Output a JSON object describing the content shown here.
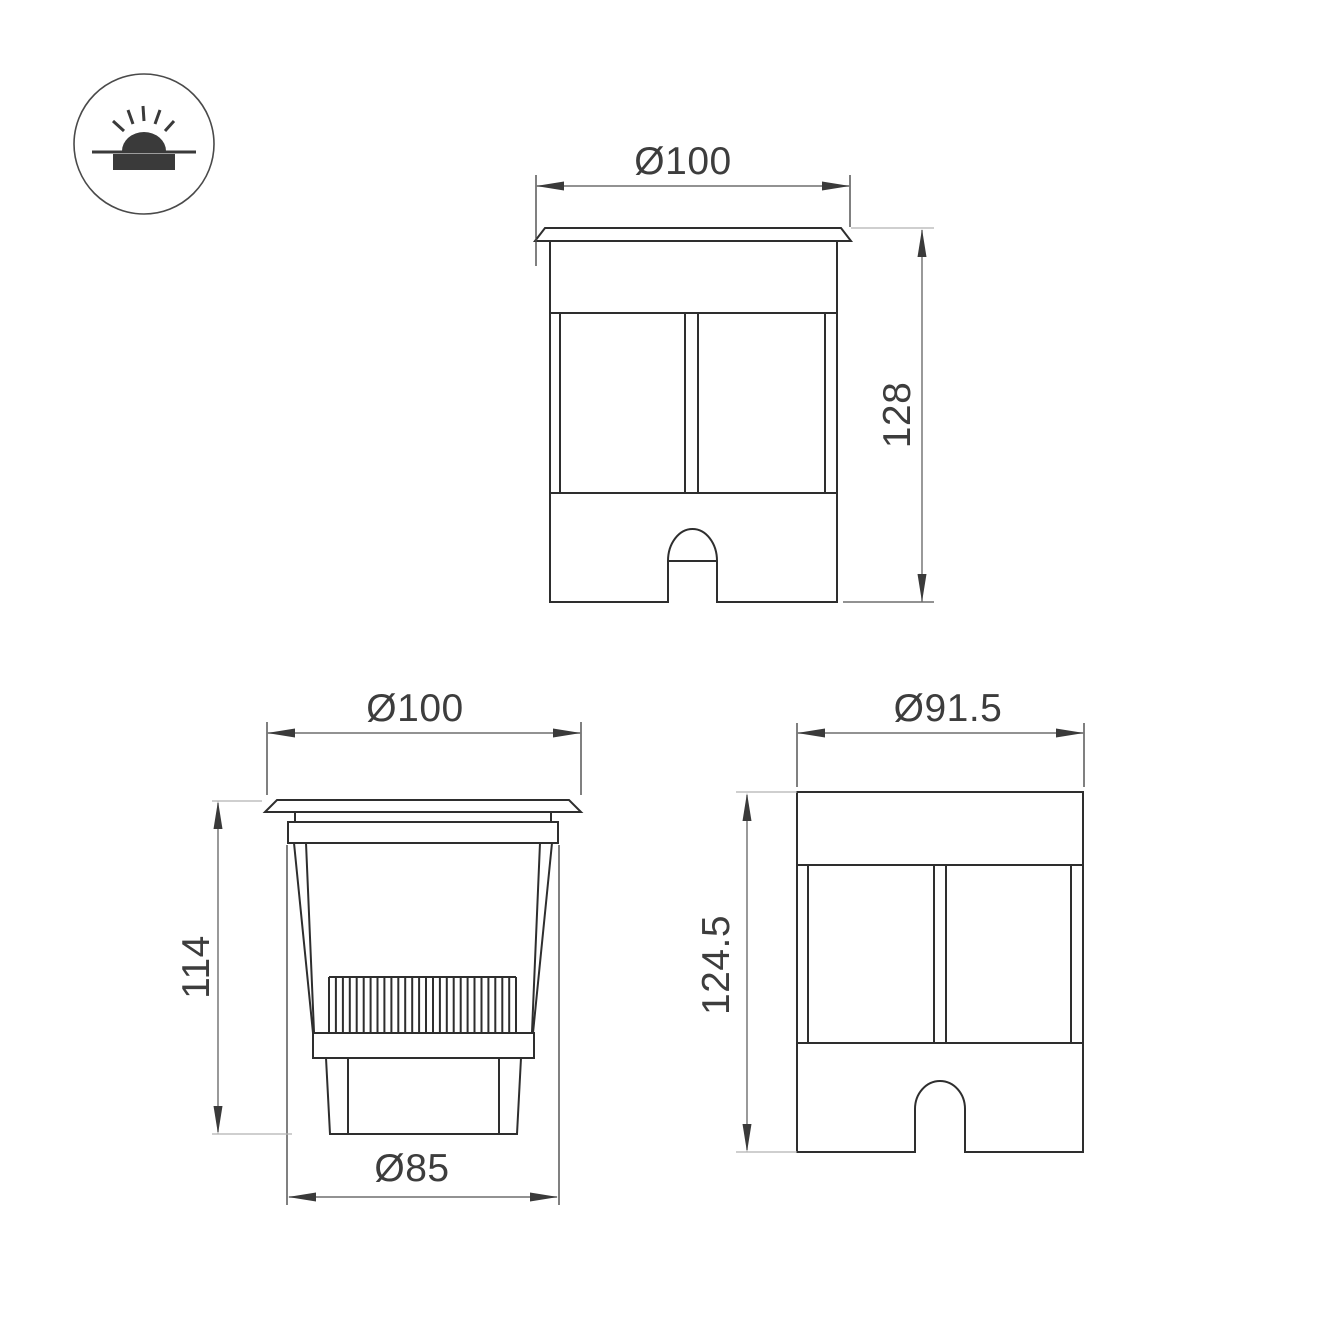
{
  "canvas": {
    "background": "#ffffff",
    "line_color": "#2e2e2e",
    "dim_line_color": "#6e6e6e",
    "ext_line_color": "#4a4a4a",
    "light_line_color": "#b2b2b2",
    "arrow_color": "#3a3a3a",
    "text_color": "#3d3d3d"
  },
  "icon": {
    "name": "recessed-ground-light-icon"
  },
  "views": {
    "top": {
      "diameter_label": "Ø100",
      "height_label": "128"
    },
    "front": {
      "diameter_label": "Ø100",
      "height_label": "114",
      "base_diameter_label": "Ø85"
    },
    "side": {
      "diameter_label": "Ø91.5",
      "height_label": "124.5"
    }
  }
}
